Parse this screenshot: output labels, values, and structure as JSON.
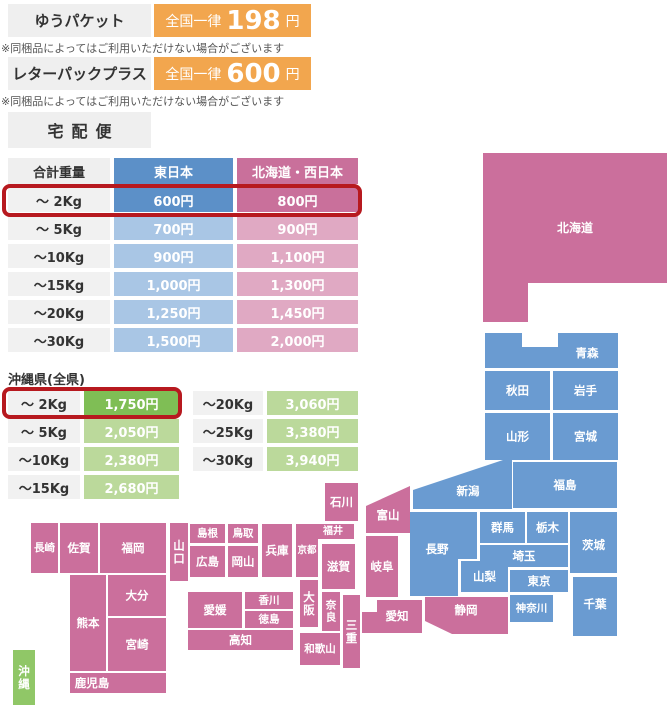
{
  "colors": {
    "orange": "#F2A64E",
    "box_gray": "#EFEFEF",
    "note_gray": "#555555",
    "text_dark": "#333333",
    "blue_strong": "#5C90C8",
    "blue_light": "#A9C6E5",
    "pink_strong": "#C9709B",
    "pink_light": "#E0A9C3",
    "green_strong": "#7FBE55",
    "green_light": "#BBD99B",
    "weight_bg": "#F1F1F1",
    "highlight_red": "#B7191F",
    "map_blue": "#6A9BD1",
    "map_pink": "#CB6F9C",
    "map_green": "#90C767"
  },
  "yupacket": {
    "label": "ゆうパケット",
    "flat_prefix": "全国一律",
    "price": "198",
    "unit": "円",
    "note": "※同梱品によってはご利用いただけない場合がございます"
  },
  "letterpack": {
    "label": "レターパックプラス",
    "flat_prefix": "全国一律",
    "price": "600",
    "unit": "円",
    "note": "※同梱品によってはご利用いただけない場合がございます"
  },
  "takuhaibin": {
    "title": "宅配便",
    "headers": [
      "合計重量",
      "東日本",
      "北海道・西日本"
    ],
    "rows": [
      {
        "weight": "～ 2Kg",
        "east": "600円",
        "west": "800円",
        "highlight": true
      },
      {
        "weight": "～ 5Kg",
        "east": "700円",
        "west": "900円",
        "highlight": false
      },
      {
        "weight": "～10Kg",
        "east": "900円",
        "west": "1,100円",
        "highlight": false
      },
      {
        "weight": "～15Kg",
        "east": "1,000円",
        "west": "1,300円",
        "highlight": false
      },
      {
        "weight": "～20Kg",
        "east": "1,250円",
        "west": "1,450円",
        "highlight": false
      },
      {
        "weight": "～30Kg",
        "east": "1,500円",
        "west": "2,000円",
        "highlight": false
      }
    ]
  },
  "okinawa": {
    "title": "沖縄県(全県)",
    "left_rows": [
      {
        "weight": "～ 2Kg",
        "price": "1,750円",
        "highlight": true
      },
      {
        "weight": "～ 5Kg",
        "price": "2,050円",
        "highlight": false
      },
      {
        "weight": "～10Kg",
        "price": "2,380円",
        "highlight": false
      },
      {
        "weight": "～15Kg",
        "price": "2,680円",
        "highlight": false
      }
    ],
    "right_rows": [
      {
        "weight": "～20Kg",
        "price": "3,060円",
        "highlight": false
      },
      {
        "weight": "～25Kg",
        "price": "3,380円",
        "highlight": false
      },
      {
        "weight": "～30Kg",
        "price": "3,940円",
        "highlight": false
      }
    ]
  },
  "map": {
    "regions": {
      "east": "map_blue",
      "west": "map_pink",
      "okinawa": "map_green"
    },
    "prefectures": [
      {
        "id": "hokkaido",
        "label": "北海道",
        "region": "west",
        "poly": [
          [
            483,
            153
          ],
          [
            667,
            153
          ],
          [
            667,
            283
          ],
          [
            528,
            283
          ],
          [
            528,
            322
          ],
          [
            483,
            322
          ]
        ],
        "lx": 575,
        "ly": 228,
        "fs": 12
      },
      {
        "id": "aomori",
        "label": "青森",
        "region": "east",
        "poly": [
          [
            485,
            333
          ],
          [
            522,
            333
          ],
          [
            522,
            347
          ],
          [
            558,
            347
          ],
          [
            558,
            333
          ],
          [
            618,
            333
          ],
          [
            618,
            368
          ],
          [
            485,
            368
          ]
        ],
        "lx": 587,
        "ly": 353
      },
      {
        "id": "akita",
        "label": "秋田",
        "region": "east",
        "rect": [
          485,
          371,
          65,
          39
        ]
      },
      {
        "id": "iwate",
        "label": "岩手",
        "region": "east",
        "rect": [
          553,
          371,
          65,
          39
        ]
      },
      {
        "id": "yamagata",
        "label": "山形",
        "region": "east",
        "rect": [
          485,
          413,
          65,
          47
        ]
      },
      {
        "id": "miyagi",
        "label": "宮城",
        "region": "east",
        "rect": [
          553,
          413,
          65,
          47
        ]
      },
      {
        "id": "fukushima",
        "label": "福島",
        "region": "east",
        "rect": [
          513,
          462,
          104,
          46
        ]
      },
      {
        "id": "niigata",
        "label": "新潟",
        "region": "east",
        "poly": [
          [
            413,
            490
          ],
          [
            512,
            457
          ],
          [
            512,
            509
          ],
          [
            413,
            509
          ]
        ],
        "lx": 468,
        "ly": 491
      },
      {
        "id": "nagano",
        "label": "長野",
        "region": "east",
        "poly": [
          [
            410,
            512
          ],
          [
            477,
            512
          ],
          [
            477,
            559
          ],
          [
            458,
            559
          ],
          [
            458,
            596
          ],
          [
            410,
            596
          ]
        ],
        "lx": 437,
        "ly": 549
      },
      {
        "id": "gunma",
        "label": "群馬",
        "region": "east",
        "rect": [
          480,
          512,
          45,
          31
        ]
      },
      {
        "id": "tochigi",
        "label": "栃木",
        "region": "east",
        "rect": [
          527,
          512,
          41,
          31
        ]
      },
      {
        "id": "ibaraki",
        "label": "茨城",
        "region": "east",
        "rect": [
          570,
          512,
          47,
          61
        ],
        "ly": 545
      },
      {
        "id": "saitama",
        "label": "埼玉",
        "region": "east",
        "rect": [
          480,
          545,
          88,
          22
        ]
      },
      {
        "id": "yamanashi",
        "label": "山梨",
        "region": "east",
        "rect": [
          461,
          561,
          47,
          31
        ]
      },
      {
        "id": "tokyo",
        "label": "東京",
        "region": "east",
        "rect": [
          510,
          570,
          58,
          22
        ]
      },
      {
        "id": "kanagawa",
        "label": "神奈川",
        "region": "east",
        "rect": [
          510,
          595,
          43,
          27
        ],
        "fs": 10.5
      },
      {
        "id": "chiba",
        "label": "千葉",
        "region": "east",
        "rect": [
          573,
          577,
          44,
          59
        ],
        "ly": 604
      },
      {
        "id": "ishikawa",
        "label": "石川",
        "region": "west",
        "rect": [
          325,
          483,
          33,
          38
        ]
      },
      {
        "id": "toyama",
        "label": "富山",
        "region": "west",
        "poly": [
          [
            366,
            506
          ],
          [
            410,
            486
          ],
          [
            410,
            533
          ],
          [
            366,
            533
          ]
        ],
        "lx": 388,
        "ly": 515
      },
      {
        "id": "fukui",
        "label": "福井",
        "region": "west",
        "rect": [
          312,
          524,
          42,
          15
        ],
        "fs": 10
      },
      {
        "id": "shiga",
        "label": "滋賀",
        "region": "west",
        "rect": [
          322,
          544,
          33,
          45
        ]
      },
      {
        "id": "kyoto",
        "label": "京都",
        "region": "west",
        "rect": [
          296,
          524,
          22,
          53
        ],
        "fs": 9.5
      },
      {
        "id": "hyogo",
        "label": "兵庫",
        "region": "west",
        "rect": [
          262,
          524,
          30,
          53
        ]
      },
      {
        "id": "tottori",
        "label": "鳥取",
        "region": "west",
        "rect": [
          228,
          524,
          30,
          19
        ],
        "fs": 10.5
      },
      {
        "id": "shimane",
        "label": "島根",
        "region": "west",
        "rect": [
          190,
          524,
          35,
          19
        ],
        "fs": 10.5
      },
      {
        "id": "okayama",
        "label": "岡山",
        "region": "west",
        "rect": [
          228,
          546,
          30,
          31
        ]
      },
      {
        "id": "hiroshima",
        "label": "広島",
        "region": "west",
        "rect": [
          190,
          546,
          35,
          31
        ]
      },
      {
        "id": "yamaguchi",
        "label": "山口",
        "region": "west",
        "rect": [
          170,
          523,
          18,
          58
        ],
        "vertical": true
      },
      {
        "id": "osaka",
        "label": "大阪",
        "region": "west",
        "rect": [
          300,
          580,
          18,
          47
        ],
        "vertical": true
      },
      {
        "id": "nara",
        "label": "奈良",
        "region": "west",
        "rect": [
          322,
          592,
          18,
          39
        ],
        "vertical": true,
        "fs": 10.5
      },
      {
        "id": "mie",
        "label": "三重",
        "region": "west",
        "rect": [
          343,
          595,
          17,
          73
        ],
        "vertical": true
      },
      {
        "id": "wakayama",
        "label": "和歌山",
        "region": "west",
        "rect": [
          300,
          633,
          40,
          32
        ],
        "fs": 10.5
      },
      {
        "id": "gifu",
        "label": "岐阜",
        "region": "west",
        "rect": [
          366,
          536,
          32,
          61
        ]
      },
      {
        "id": "aichi",
        "label": "愛知",
        "region": "west",
        "poly": [
          [
            377,
            600
          ],
          [
            422,
            600
          ],
          [
            422,
            633
          ],
          [
            362,
            633
          ],
          [
            362,
            612
          ],
          [
            377,
            612
          ]
        ],
        "lx": 397,
        "ly": 616
      },
      {
        "id": "shizuoka",
        "label": "静岡",
        "region": "west",
        "poly": [
          [
            425,
            597
          ],
          [
            508,
            597
          ],
          [
            508,
            634
          ],
          [
            452,
            634
          ],
          [
            425,
            621
          ]
        ],
        "lx": 466,
        "ly": 610
      },
      {
        "id": "ehime",
        "label": "愛媛",
        "region": "west",
        "rect": [
          188,
          592,
          54,
          36
        ]
      },
      {
        "id": "kagawa",
        "label": "香川",
        "region": "west",
        "rect": [
          245,
          592,
          48,
          17
        ],
        "fs": 10.5
      },
      {
        "id": "tokushima",
        "label": "徳島",
        "region": "west",
        "rect": [
          245,
          611,
          48,
          17
        ],
        "fs": 10.5
      },
      {
        "id": "kochi",
        "label": "高知",
        "region": "west",
        "rect": [
          188,
          630,
          105,
          20
        ]
      },
      {
        "id": "nagasaki",
        "label": "長崎",
        "region": "west",
        "rect": [
          31,
          523,
          27,
          50
        ],
        "fs": 10.5
      },
      {
        "id": "saga",
        "label": "佐賀",
        "region": "west",
        "rect": [
          60,
          523,
          38,
          50
        ]
      },
      {
        "id": "fukuoka",
        "label": "福岡",
        "region": "west",
        "rect": [
          100,
          523,
          66,
          50
        ]
      },
      {
        "id": "kumamoto",
        "label": "熊本",
        "region": "west",
        "rect": [
          70,
          575,
          36,
          96
        ]
      },
      {
        "id": "oita",
        "label": "大分",
        "region": "west",
        "rect": [
          108,
          575,
          58,
          41
        ]
      },
      {
        "id": "miyazaki",
        "label": "宮崎",
        "region": "west",
        "rect": [
          108,
          618,
          58,
          53
        ]
      },
      {
        "id": "kagoshima",
        "label": "鹿児島",
        "region": "west",
        "rect": [
          70,
          673,
          96,
          20
        ],
        "lx": 92,
        "ly": 683
      },
      {
        "id": "okinawa",
        "label": "沖縄",
        "region": "okinawa",
        "rect": [
          13,
          650,
          22,
          55
        ],
        "vertical": true
      }
    ]
  }
}
